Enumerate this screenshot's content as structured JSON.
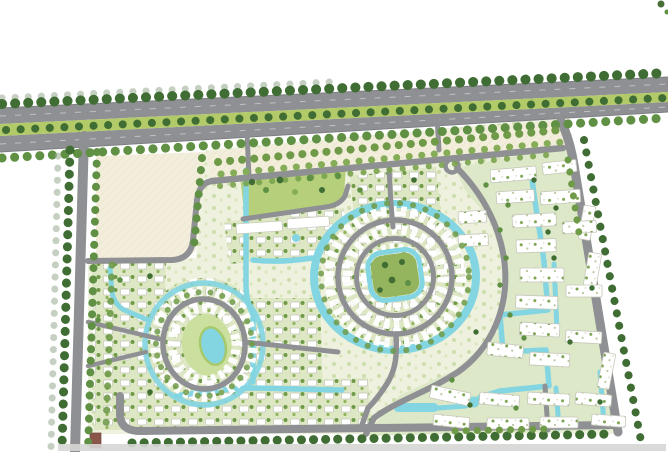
{
  "map": {
    "title": "residential-masterplan-site-map",
    "type": "landscape-architecture-site-plan",
    "features": [
      "main-boulevard",
      "boulevard-median",
      "street-tree-rows",
      "vacant-sand-parcel",
      "parking-band",
      "north-collector-road",
      "west-access-road",
      "east-boundary-road",
      "south-access-road",
      "villa-districts",
      "central-ring-neighborhood",
      "ring-central-park",
      "oval-lagoon-neighborhood",
      "oval-lagoon",
      "community-park",
      "water-canals",
      "apartment-district",
      "apartment-blocks",
      "swimming-pool",
      "pond",
      "brown-roof-building"
    ],
    "colors": {
      "background": "#ffffff",
      "road": "#8f9093",
      "road_edge": "#7e7f83",
      "lane_line": "#c8c9cb",
      "median_green": "#b3ca69",
      "sand": "#f3eedb",
      "dev_base": "#edf1dd",
      "villa_bg": "#dde7c3",
      "water": "#83d5e2",
      "water_rim": "#a6c96d",
      "park_green": "#b5cf7a",
      "ring_park": "#95b45e",
      "oval_green": "#cbe09f",
      "building_white": "#ffffff",
      "building_stroke": "#c6c8ba",
      "tree_dark": "#3f6d33",
      "tree_mid": "#5f9043",
      "tree_light": "#85ad57",
      "tree_shadow": "#98aa90",
      "brown_building": "#8b564a",
      "bottom_band": "#d6d7d4"
    }
  }
}
